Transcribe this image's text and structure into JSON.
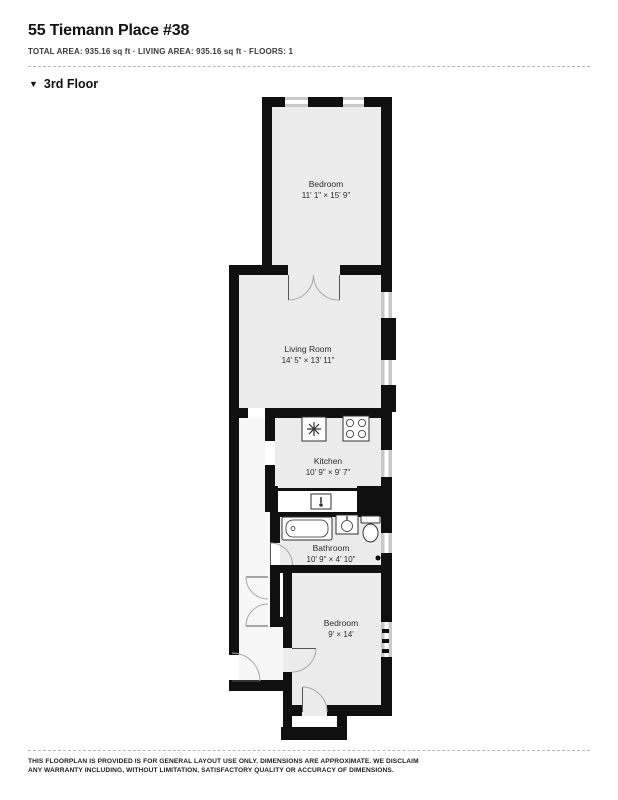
{
  "header": {
    "title": "55 Tiemann Place #38",
    "meta": "TOTAL AREA: 935.16 sq ft · LIVING AREA: 935.16 sq ft · FLOORS: 1"
  },
  "floor": {
    "marker": "▼",
    "label": "3rd Floor"
  },
  "rooms": [
    {
      "name": "Bedroom",
      "dims": "11' 1\" × 15' 9\""
    },
    {
      "name": "Living Room",
      "dims": "14' 5\" × 13' 11\""
    },
    {
      "name": "Kitchen",
      "dims": "10' 9\" × 9' 7\""
    },
    {
      "name": "Bathroom",
      "dims": "10' 9\" × 4' 10\""
    },
    {
      "name": "Bedroom",
      "dims": "9' × 14'"
    }
  ],
  "icons": [
    "kitchen-sink-icon",
    "stove-icon",
    "counter-sink-icon",
    "bathtub-icon",
    "bathroom-sink-icon",
    "toilet-icon"
  ],
  "colors": {
    "wall": "#101010",
    "room_floor": "#ececec",
    "hall_floor": "#f7f7f7",
    "window": "#c9c9c9",
    "arc": "#a8a8a8",
    "leaf": "#555555",
    "fixture": "#2f2f2f",
    "text": "#2b2b2b",
    "dash": "#b8b8b8"
  },
  "footer": {
    "disclaimer": "THIS FLOORPLAN IS PROVIDED IS FOR GENERAL LAYOUT USE ONLY. DIMENSIONS ARE APPROXIMATE. WE DISCLAIM ANY WARRANTY INCLUDING, WITHOUT LIMITATION, SATISFACTORY QUALITY OR ACCURACY OF DIMENSIONS."
  }
}
